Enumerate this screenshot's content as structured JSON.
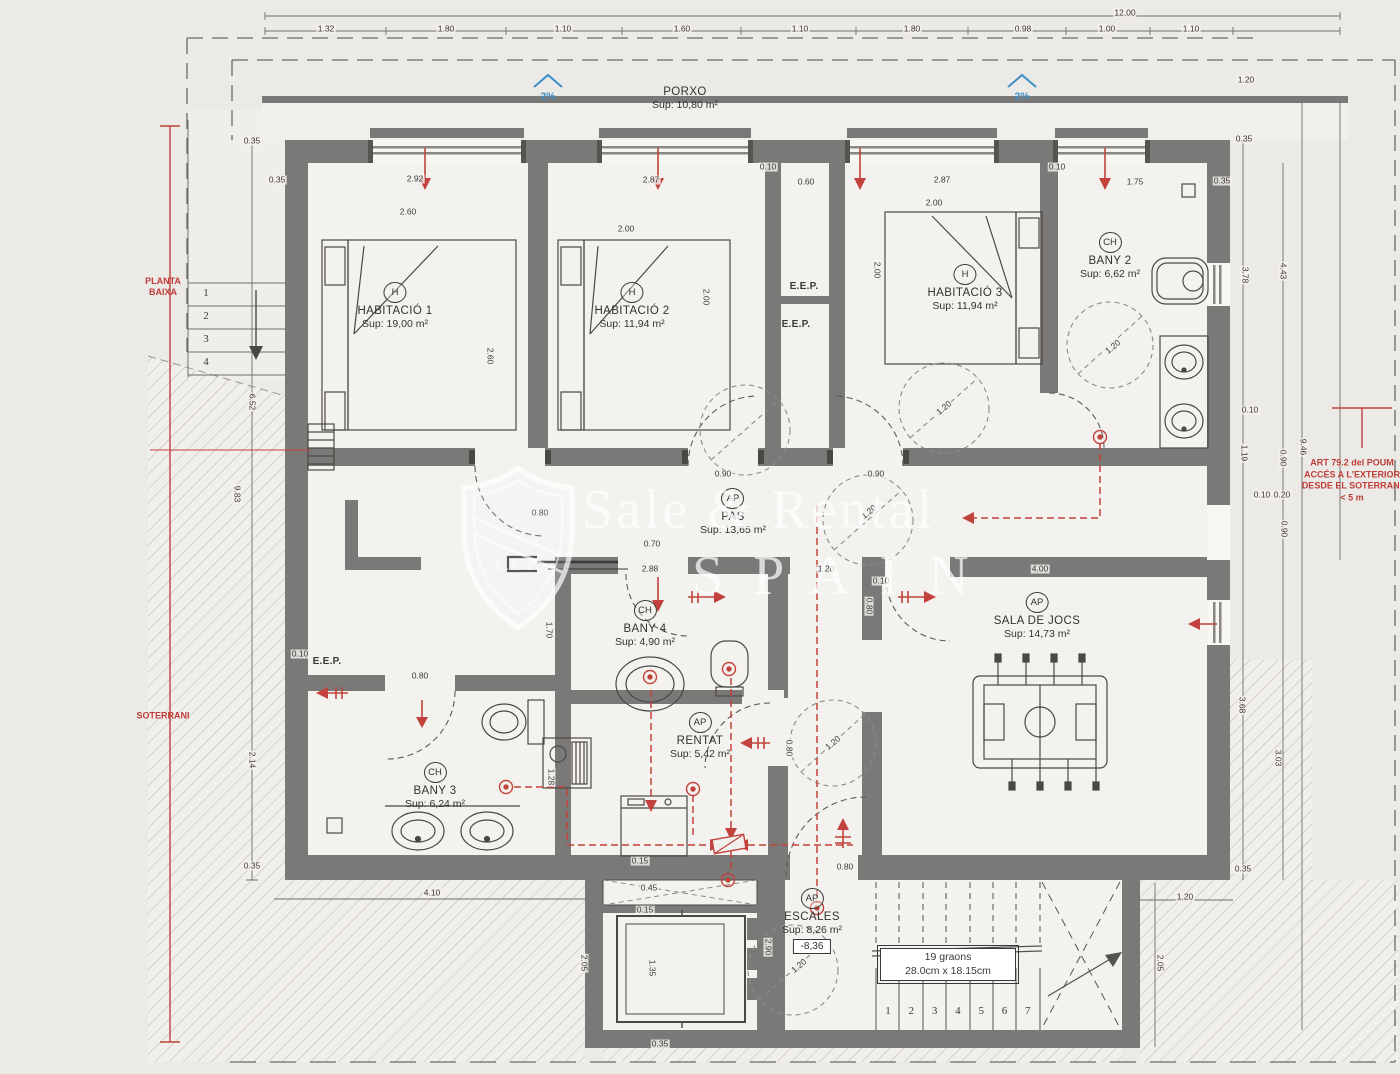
{
  "watermark": {
    "line1": "Sale & Rental",
    "line2": "SPAIN",
    "badge": "E.E.P."
  },
  "stairs_box": {
    "line1": "19 graons",
    "line2": "28.0cm x 18.15cm"
  },
  "stairs": {
    "lower_steps": [
      "1",
      "2",
      "3",
      "4",
      "5",
      "6",
      "7"
    ],
    "upper_steps": [
      "1",
      "2",
      "3",
      "4"
    ]
  },
  "eep": {
    "label": "E.E.P.",
    "positions": [
      {
        "x": 804,
        "y": 287
      },
      {
        "x": 796,
        "y": 325
      },
      {
        "x": 327,
        "y": 662
      }
    ]
  },
  "rooms": [
    {
      "tag": "",
      "name": "PORXO",
      "sup": "Sup: 10,80 m²",
      "x": 685,
      "y": 84
    },
    {
      "tag": "H",
      "name": "HABITACIÓ 1",
      "sup": "Sup: 19,00 m²",
      "x": 395,
      "y": 282
    },
    {
      "tag": "H",
      "name": "HABITACIÓ 2",
      "sup": "Sup: 11,94 m²",
      "x": 632,
      "y": 282
    },
    {
      "tag": "H",
      "name": "HABITACIÓ 3",
      "sup": "Sup: 11,94 m²",
      "x": 965,
      "y": 264
    },
    {
      "tag": "CH",
      "name": "BANY 2",
      "sup": "Sup: 6,62 m²",
      "x": 1110,
      "y": 232
    },
    {
      "tag": "AP",
      "name": "PAS",
      "sup": "Sup: 13,65 m²",
      "x": 733,
      "y": 488
    },
    {
      "tag": "CH",
      "name": "BANY 4",
      "sup": "Sup: 4,90 m²",
      "x": 645,
      "y": 600
    },
    {
      "tag": "CH",
      "name": "BANY 3",
      "sup": "Sup: 6,24 m²",
      "x": 435,
      "y": 762
    },
    {
      "tag": "AP",
      "name": "RENTAT",
      "sup": "Sup: 5,42 m²",
      "x": 700,
      "y": 712
    },
    {
      "tag": "AP",
      "name": "SALA DE JOCS",
      "sup": "Sup: 14,73 m²",
      "x": 1037,
      "y": 592
    },
    {
      "tag": "AP",
      "name": "ESCALES",
      "sup": "Sup: 8,26 m²",
      "level": "-8,36",
      "x": 812,
      "y": 888
    }
  ],
  "annotations": [
    {
      "t": "12.00",
      "x": 1125,
      "y": 13
    },
    {
      "t": "1.32",
      "x": 326,
      "y": 29
    },
    {
      "t": "1.80",
      "x": 446,
      "y": 29
    },
    {
      "t": "1.10",
      "x": 563,
      "y": 29
    },
    {
      "t": "1.60",
      "x": 682,
      "y": 29
    },
    {
      "t": "1.10",
      "x": 800,
      "y": 29
    },
    {
      "t": "1.80",
      "x": 912,
      "y": 29
    },
    {
      "t": "0.98",
      "x": 1023,
      "y": 29
    },
    {
      "t": "1.00",
      "x": 1107,
      "y": 29
    },
    {
      "t": "1.10",
      "x": 1191,
      "y": 29
    },
    {
      "t": "1.20",
      "x": 1246,
      "y": 80
    },
    {
      "t": "0.35",
      "x": 277,
      "y": 180
    },
    {
      "t": "2.92",
      "x": 415,
      "y": 179
    },
    {
      "t": "2.87",
      "x": 651,
      "y": 180
    },
    {
      "t": "0.10",
      "x": 768,
      "y": 167
    },
    {
      "t": "0.60",
      "x": 806,
      "y": 182
    },
    {
      "t": "2.87",
      "x": 942,
      "y": 180
    },
    {
      "t": "0.10",
      "x": 1057,
      "y": 167
    },
    {
      "t": "1.75",
      "x": 1135,
      "y": 182
    },
    {
      "t": "0.35",
      "x": 1222,
      "y": 181
    },
    {
      "t": "2.60",
      "x": 408,
      "y": 212
    },
    {
      "t": "2.60",
      "x": 490,
      "y": 356,
      "r": 90
    },
    {
      "t": "2.00",
      "x": 626,
      "y": 229
    },
    {
      "t": "2.00",
      "x": 706,
      "y": 297,
      "r": 90
    },
    {
      "t": "2.00",
      "x": 934,
      "y": 203
    },
    {
      "t": "2.00",
      "x": 877,
      "y": 270,
      "r": 90
    },
    {
      "t": "0.90",
      "x": 723,
      "y": 474
    },
    {
      "t": "0.90",
      "x": 876,
      "y": 474
    },
    {
      "t": "0.80",
      "x": 540,
      "y": 513
    },
    {
      "t": "1.20",
      "x": 1113,
      "y": 347,
      "r": -40
    },
    {
      "t": "1.20",
      "x": 944,
      "y": 408,
      "r": -40
    },
    {
      "t": "1.20",
      "x": 869,
      "y": 512,
      "r": -40
    },
    {
      "t": "1.20",
      "x": 833,
      "y": 743,
      "r": -40
    },
    {
      "t": "1.20",
      "x": 799,
      "y": 966,
      "r": -40
    },
    {
      "t": "0.70",
      "x": 652,
      "y": 544
    },
    {
      "t": "2.88",
      "x": 650,
      "y": 569
    },
    {
      "t": "1.20",
      "x": 826,
      "y": 569
    },
    {
      "t": "0.10",
      "x": 881,
      "y": 581
    },
    {
      "t": "0.80",
      "x": 869,
      "y": 606,
      "r": 90
    },
    {
      "t": "1.70",
      "x": 549,
      "y": 630,
      "r": 90
    },
    {
      "t": "1.28",
      "x": 551,
      "y": 777,
      "r": 90
    },
    {
      "t": "0.80",
      "x": 789,
      "y": 748,
      "r": 90
    },
    {
      "t": "0.80",
      "x": 420,
      "y": 676
    },
    {
      "t": "0.10",
      "x": 300,
      "y": 654
    },
    {
      "t": "4.00",
      "x": 1040,
      "y": 569
    },
    {
      "t": "0.35",
      "x": 1244,
      "y": 139
    },
    {
      "t": "3.78",
      "x": 1245,
      "y": 275,
      "r": 90
    },
    {
      "t": "4.43",
      "x": 1283,
      "y": 271,
      "r": 90
    },
    {
      "t": "0.10",
      "x": 1250,
      "y": 410
    },
    {
      "t": "1.19",
      "x": 1244,
      "y": 453,
      "r": 90
    },
    {
      "t": "0.90",
      "x": 1283,
      "y": 458,
      "r": 90
    },
    {
      "t": "9.46",
      "x": 1303,
      "y": 447,
      "r": 90
    },
    {
      "t": "0.10",
      "x": 1262,
      "y": 495
    },
    {
      "t": "0.20",
      "x": 1282,
      "y": 495
    },
    {
      "t": "0.90",
      "x": 1284,
      "y": 529,
      "r": 90
    },
    {
      "t": "3.68",
      "x": 1242,
      "y": 705,
      "r": 90
    },
    {
      "t": "3.03",
      "x": 1278,
      "y": 758,
      "r": 90
    },
    {
      "t": "0.35",
      "x": 1243,
      "y": 869
    },
    {
      "t": "1.20",
      "x": 1185,
      "y": 897
    },
    {
      "t": "2.05",
      "x": 1160,
      "y": 963,
      "r": 90
    },
    {
      "t": "0.35",
      "x": 252,
      "y": 141
    },
    {
      "t": "6.52",
      "x": 252,
      "y": 402,
      "r": 90
    },
    {
      "t": "9.83",
      "x": 237,
      "y": 494,
      "r": 90
    },
    {
      "t": "2.14",
      "x": 252,
      "y": 760,
      "r": 90
    },
    {
      "t": "0.35",
      "x": 252,
      "y": 866
    },
    {
      "t": "4.10",
      "x": 432,
      "y": 893
    },
    {
      "t": "2.05",
      "x": 584,
      "y": 963,
      "r": 90
    },
    {
      "t": "0.15",
      "x": 640,
      "y": 861
    },
    {
      "t": "0.45",
      "x": 649,
      "y": 888
    },
    {
      "t": "0.15",
      "x": 645,
      "y": 910
    },
    {
      "t": "1.35",
      "x": 652,
      "y": 968,
      "r": 90
    },
    {
      "t": "0.35",
      "x": 660,
      "y": 1044
    },
    {
      "t": "0.80",
      "x": 845,
      "y": 867
    },
    {
      "t": "2.90",
      "x": 768,
      "y": 947,
      "r": 90
    },
    {
      "t": "2%",
      "x": 548,
      "y": 97,
      "c": "blue",
      "n": "slope-label"
    },
    {
      "t": "2%",
      "x": 1022,
      "y": 97,
      "c": "blue",
      "n": "slope-label"
    },
    {
      "t": "PLANTA BAIXA",
      "x": 163,
      "y": 287,
      "c": "redside",
      "w": 54,
      "n": "level-label-planta-baixa"
    },
    {
      "t": "SOTERRANI",
      "x": 163,
      "y": 716,
      "c": "redside",
      "w": 84,
      "n": "level-label-soterrani"
    },
    {
      "t": "ART 79.2 del POUM\nACCÉS A L'EXTERIOR\nDESDE EL SOTERRANI\n< 5 m",
      "x": 1352,
      "y": 481,
      "c": "art",
      "w": 110,
      "n": "regulation-note"
    }
  ]
}
